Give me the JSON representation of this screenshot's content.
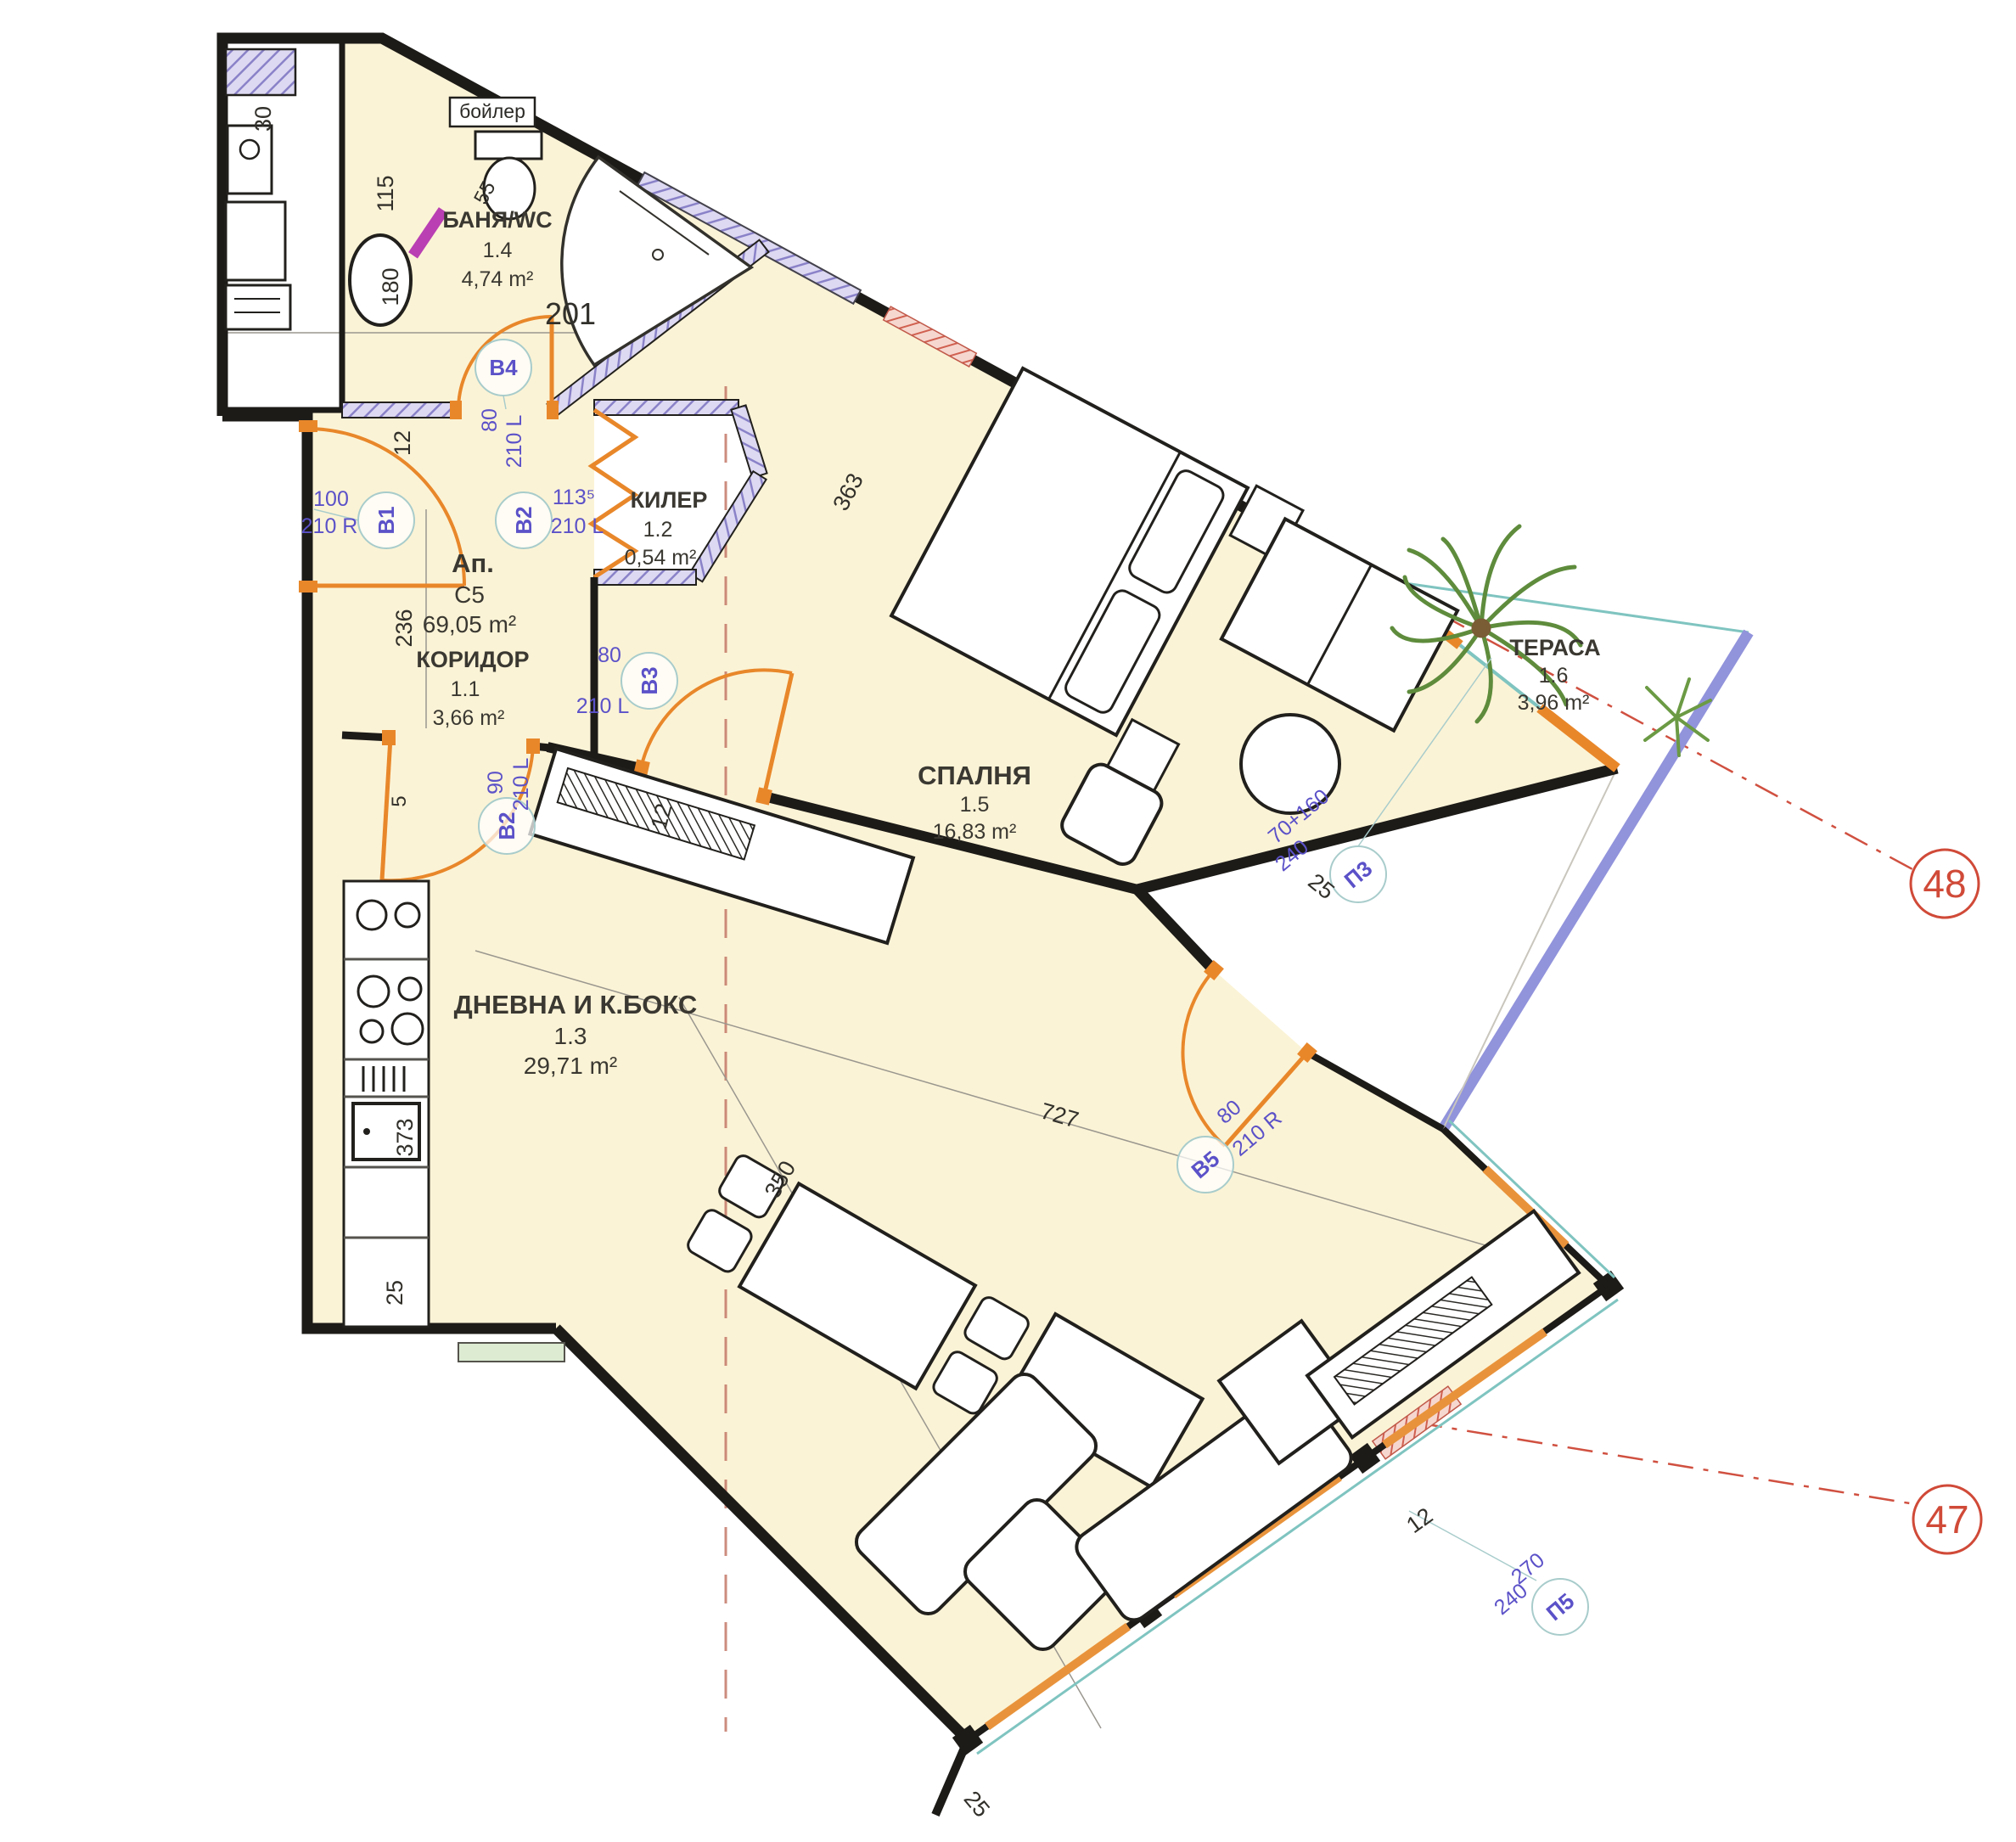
{
  "apartment": {
    "label": "Ап.",
    "code": "C5",
    "area": "69,05 m²"
  },
  "entry_number_dim": "201",
  "labels": {
    "boiler": "бойлер"
  },
  "rooms": {
    "bath": {
      "name": "БАНЯ/WC",
      "number": "1.4",
      "area": "4,74 m²"
    },
    "kiler": {
      "name": "КИЛЕР",
      "number": "1.2",
      "area": "0,54 m²"
    },
    "corridor": {
      "name": "КОРИДОР",
      "number": "1.1",
      "area": "3,66 m²"
    },
    "living": {
      "name": "ДНЕВНА И К.БОКС",
      "number": "1.3",
      "area": "29,71 m²"
    },
    "bedroom": {
      "name": "СПАЛНЯ",
      "number": "1.5",
      "area": "16,83 m²"
    },
    "terrace": {
      "name": "ТЕРАСА",
      "number": "1.6",
      "area": "3,96 m²"
    }
  },
  "doors": {
    "b1": {
      "tag": "B1",
      "width": "100",
      "height": "210 R"
    },
    "b4": {
      "tag": "B4",
      "width": "80",
      "height": "210 L"
    },
    "b2_kiler": {
      "tag": "B2",
      "width": "113⁵",
      "height": "210 L"
    },
    "b3": {
      "tag": "B3",
      "width": "80",
      "height": "210 L"
    },
    "b2_living": {
      "tag": "B2",
      "width": "90",
      "height": "210 L"
    },
    "b5": {
      "tag": "B5",
      "width": "80",
      "height": "210 R"
    }
  },
  "windows": {
    "p3": {
      "tag": "П3",
      "width": "70+160",
      "height": "240"
    },
    "p5": {
      "tag": "П5",
      "width": "270",
      "height": "240"
    }
  },
  "dims": {
    "duct": "30",
    "fixtures": "115",
    "tub": "180",
    "bath_wall": "12",
    "bath_width": "201",
    "corridor_length": "236",
    "kitchen_wall": "5",
    "counter_length": "373",
    "counter_end": "25",
    "shower": "55",
    "bed": "363",
    "bedroom_wall": "12",
    "living_width": "727",
    "living_diag": "350",
    "terrace_wall": "25",
    "glass_wall": "12",
    "tip": "25"
  },
  "axes": {
    "a48": "48",
    "a47": "47"
  },
  "colors": {
    "room_fill": "#fbf3d6",
    "wall": "#1d1b18",
    "door_arc": "#e8872a",
    "tag_text": "#5b51c8",
    "axis_red": "#d04a38",
    "railing": "#9193db",
    "glass": "#7fc4c0",
    "hatch_wall": "#ddd9f2"
  }
}
